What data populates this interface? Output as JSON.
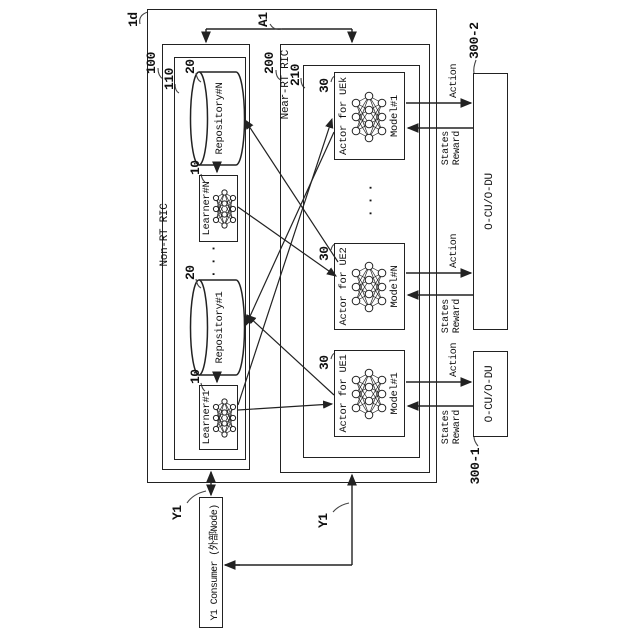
{
  "figure": {
    "outer_ref": "1d",
    "a1_label": "A1",
    "y1_label_top": "Y1",
    "y1_label_side": "Y1",
    "non_rt": {
      "ref": "100",
      "title": "Non-RT RIC",
      "inner_ref": "110",
      "learner1": {
        "ref": "10",
        "title": "Learner#1"
      },
      "repo1": {
        "ref": "20",
        "title": "Repository#1"
      },
      "learnerN": {
        "ref": "10",
        "title": "Learner#N"
      },
      "repoN": {
        "ref": "20",
        "title": "Repository#N"
      },
      "dots": "···"
    },
    "near_rt": {
      "ref": "200",
      "title": "Near-RT RIC",
      "inner_ref": "210",
      "actor1": {
        "ref": "30",
        "title": "Actor for UE1",
        "model": "Model#1"
      },
      "actor2": {
        "ref": "30",
        "title": "Actor for UE2",
        "model": "Model#N"
      },
      "actork": {
        "ref": "30",
        "title": "Actor for UEk",
        "model": "Model#1"
      },
      "dots": "···"
    },
    "ran": {
      "ref1": "300-1",
      "label1": "O-CU/O-DU",
      "ref2": "300-2",
      "label2": "O-CU/O-DU"
    },
    "signals": {
      "action": "Action",
      "states": "States",
      "reward": "Reward"
    },
    "consumer_label": "Y1 Consumer (外部Node)",
    "colors": {
      "line": "#222222",
      "text": "#111111",
      "background": "#ffffff"
    }
  }
}
